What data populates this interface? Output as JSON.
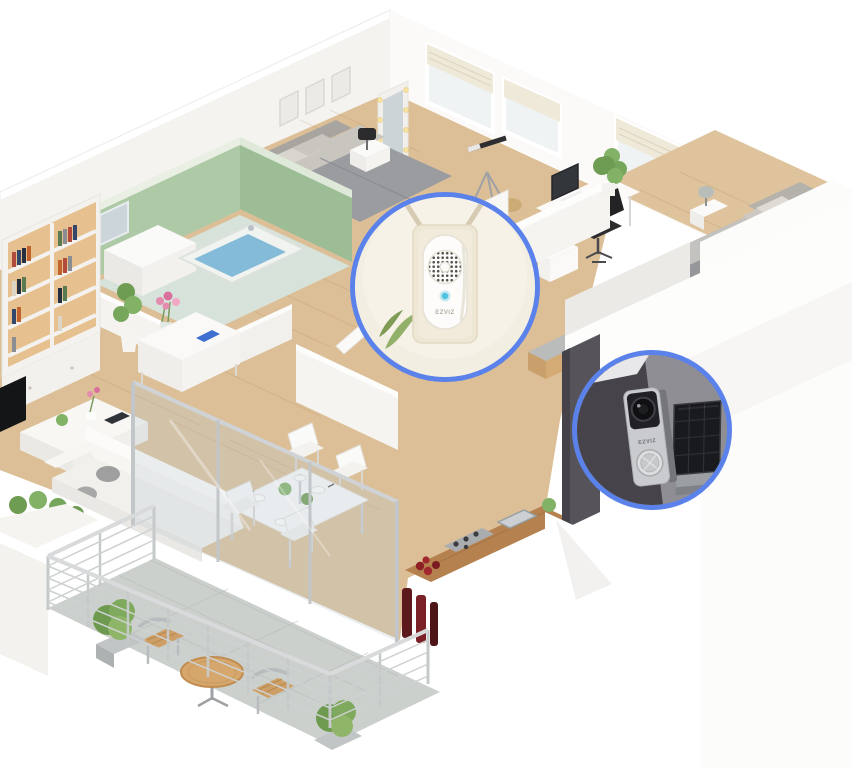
{
  "image": {
    "description": "3D isometric apartment floor plan with two circular smart-device callouts",
    "brand": "EZVIZ"
  },
  "scene": {
    "background_color": "#ffffff",
    "wood_floor_color": "#ddc29b",
    "wall_color": "#f7f5f2",
    "bathroom_tile_color": "#adc9a6",
    "bathtub_water_color": "#84bbd8",
    "balcony_floor_color": "#ccd0cd",
    "bed_color": "#9a9ca0",
    "rooms": [
      "bathroom",
      "master-bedroom",
      "home-office",
      "second-bedroom",
      "hallway",
      "living-room",
      "dining-room",
      "kitchen",
      "entrance",
      "balcony"
    ]
  },
  "callouts": {
    "ring_color": "#5b82ea",
    "chime": {
      "device": "plug-in chime",
      "brand_label": "EZVIZ",
      "led_color": "#4fc3df",
      "wall_color": "#f3eee2"
    },
    "doorbell": {
      "device": "battery video doorbell with solar panel",
      "brand_label": "EZVIZ",
      "body_color": "#c9cbce",
      "solar_panel_color": "#191a1e"
    }
  }
}
